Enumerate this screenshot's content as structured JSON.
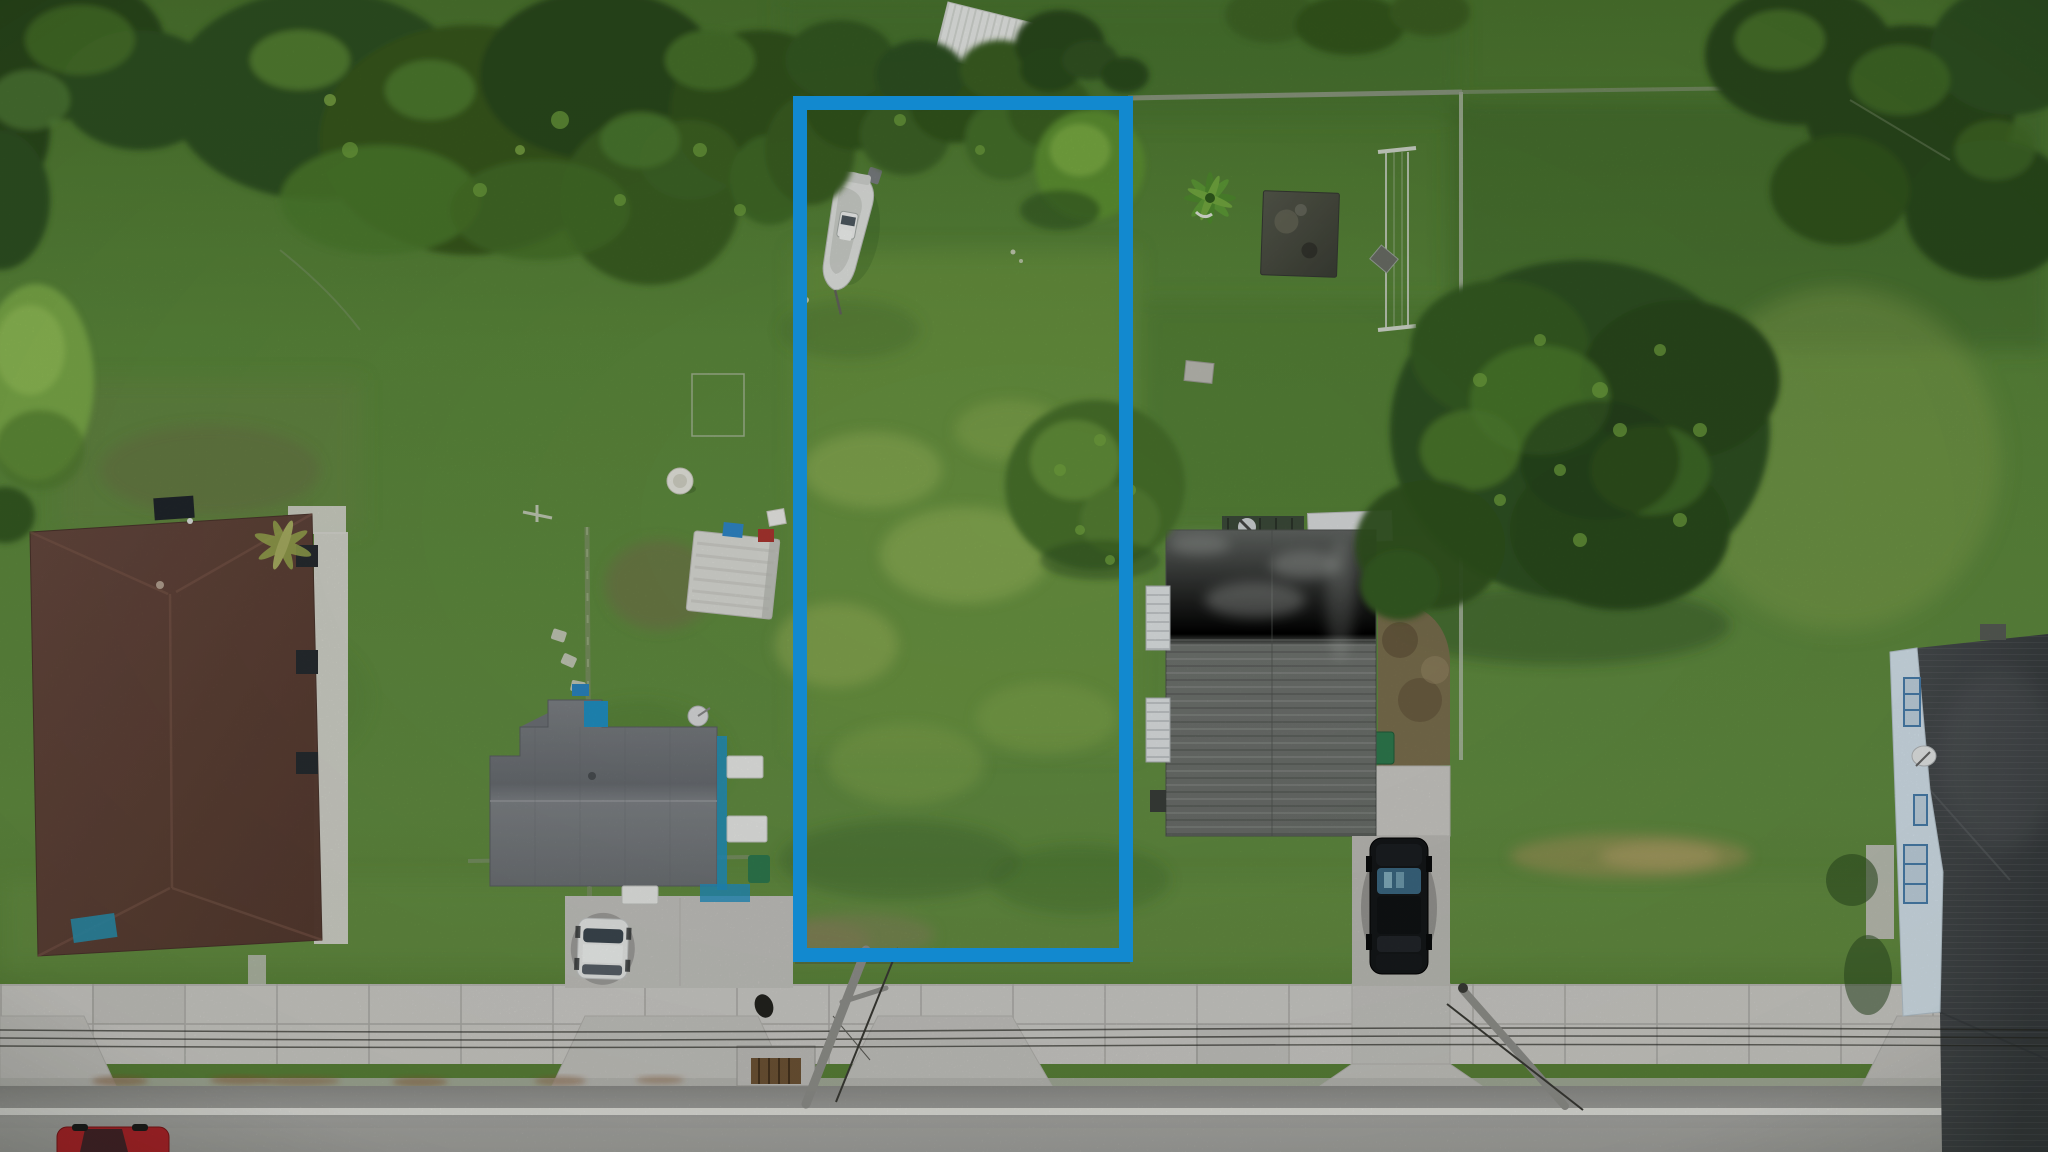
{
  "image": {
    "kind": "aerial-drone-photograph",
    "description": "Overhead drone photo of a suburban street; a narrow vacant grass lot between houses is outlined with a thick blue property-boundary rectangle; concrete sidewalk and asphalt road run along the bottom.",
    "width": 2048,
    "height": 1152
  },
  "annotation": {
    "boundary": {
      "x": 800,
      "y": 103,
      "width": 326,
      "height": 852,
      "stroke_width": 14,
      "color": "#1289cf"
    }
  },
  "palette": {
    "boundary_blue": "#1289cf",
    "grass_top": "#4c762f",
    "grass_base": "#5b883b",
    "grass_mid": "#628d41",
    "grass_bottom": "#587f36",
    "grass_yellow": "#9cb55e",
    "grass_dark": "#3f6628",
    "tree_dark": "#2b481c",
    "tree_mid": "#365a22",
    "tree_light": "#4d7a2e",
    "tree_bright": "#6fa03e",
    "road_dark": "#8f8f8c",
    "road_light": "#a8a8a5",
    "road_line": "#e8e8e4",
    "sidewalk": "#cecdc9",
    "concrete": "#c6c5c1",
    "curb_rust": "#8a5a33",
    "left_roof_a": "#664740",
    "left_roof_b": "#55392f",
    "center_roof_a": "#7c8084",
    "center_roof_b": "#686c71",
    "right_roof_a": "#606461",
    "right_roof_b": "#6e726e",
    "far_roof_a": "#474b4e",
    "far_roof_b": "#383c3f",
    "far_wall": "#d6e4ee",
    "window_frame": "#4a7fae",
    "teal": "#2090c2",
    "shed": "#d8d9d4",
    "boat": "#e0e2df",
    "dirt": "#7d6c4f",
    "white_paint": "#eaece9",
    "car_white": "#e9ebea",
    "car_black": "#141619",
    "car_red": "#b3242a",
    "truck_blue": "#1e3c5e",
    "wire": "#24241f",
    "pole_shadow": "#91918d",
    "fence_moss": "#7f9168",
    "fence_light": "#b9c0b2",
    "dumpster_green": "#2e7a4e",
    "drain_rust": "#6f5436"
  },
  "objects": [
    "property-boundary",
    "vacant-lot",
    "boat",
    "pickup-truck",
    "house-left",
    "house-center",
    "white-car",
    "shed",
    "birdbath",
    "garden-pen",
    "house-right",
    "black-suv",
    "clothesline-frame",
    "burn-patch",
    "palm-tree",
    "house-far-right",
    "large-oak-tree",
    "white-canopy-structure",
    "sidewalk",
    "road",
    "power-lines",
    "storm-drain",
    "red-car"
  ]
}
